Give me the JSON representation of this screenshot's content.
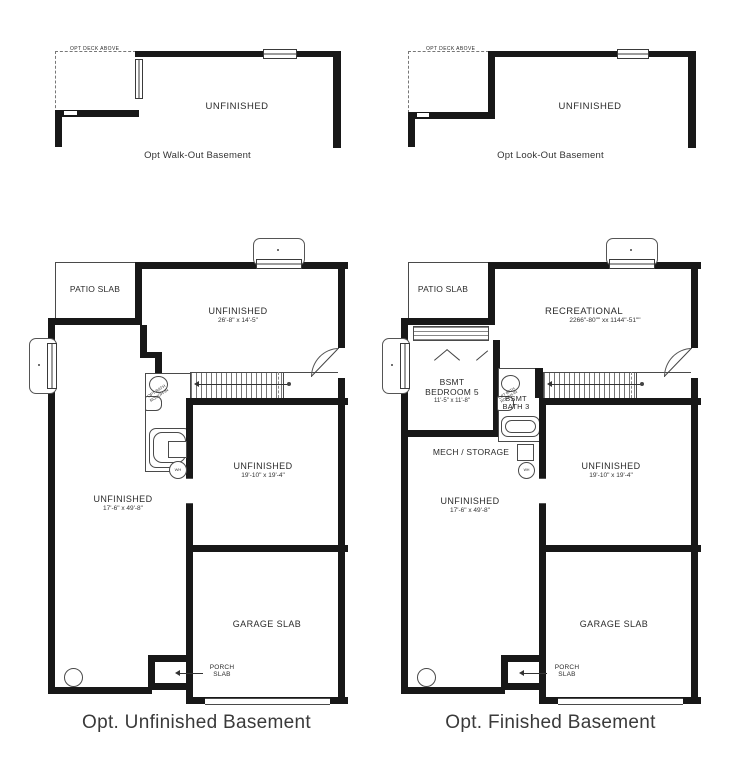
{
  "colors": {
    "wall": "#181818",
    "thin_line": "#4a4a4a",
    "text": "#2b2b2b",
    "background": "#ffffff"
  },
  "icons": {
    "water_heater": "WH",
    "sump_pit": "circle",
    "window_well": "rounded-rect",
    "stairs": "hatched-band"
  },
  "plans": {
    "walkout": {
      "caption": "Opt Walk-Out Basement",
      "deck": "OPT DECK ABOVE",
      "room": "UNFINISHED"
    },
    "lookout": {
      "caption": "Opt Look-Out Basement",
      "deck": "OPT DECK ABOVE",
      "room": "UNFINISHED"
    },
    "unfinished": {
      "caption": "Opt. Unfinished Basement",
      "patio": "PATIO SLAB",
      "room_top": "UNFINISHED",
      "room_top_dims": "26'-8\" x 14'-5\"",
      "room_right": "UNFINISHED",
      "room_right_dims": "19'-10\" x 19'-4\"",
      "room_left": "UNFINISHED",
      "room_left_dims": "17'-6\" x 49'-8\"",
      "garage": "GARAGE SLAB",
      "porch": "PORCH SLAB",
      "bath_note": "OPT BATH ROUGH-IN",
      "wh": "WH"
    },
    "finished": {
      "caption": "Opt. Finished Basement",
      "patio": "PATIO SLAB",
      "rec": "RECREATIONAL",
      "rec_dims": "2266\"-80\"\" xx 1144\"-51\"\"",
      "bedroom_line1": "BSMT",
      "bedroom_line2": "BEDROOM 5",
      "bedroom_dims": "11'-5\" x 11'-8\"",
      "bath_line1": "BSMT",
      "bath_line2": "BATH 3",
      "mech": "MECH / STORAGE",
      "room_right": "UNFINISHED",
      "room_right_dims": "19'-10\" x 19'-4\"",
      "room_left": "UNFINISHED",
      "room_left_dims": "17'-6\" x 49'-8\"",
      "garage": "GARAGE SLAB",
      "porch": "PORCH SLAB",
      "bath_note": "OPT BATH ROUGH-IN",
      "wh": "WH"
    }
  }
}
